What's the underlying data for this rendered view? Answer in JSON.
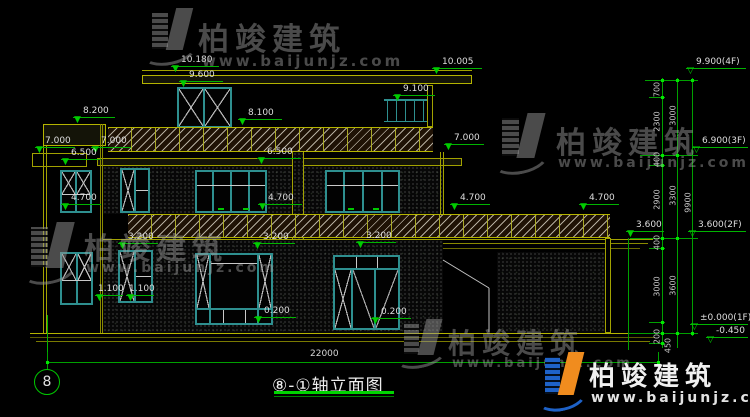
{
  "drawing": {
    "title": {
      "text": "⑧-①轴立面图"
    },
    "axis_bubble": "8",
    "total_dim": "22000"
  },
  "levels": [
    "10.180",
    "9.600",
    "10.005",
    "9.100",
    "8.200",
    "8.100",
    "7.000",
    "7.000",
    "6.500",
    "6.500",
    "7.000",
    "4.700",
    "4.700",
    "4.700",
    "4.700",
    "3.600",
    "3.200",
    "3.200",
    "3.200",
    "1.100",
    "1.100",
    "0.200",
    "0.200"
  ],
  "right_levels": [
    "9.900(4F)",
    "6.900(3F)",
    "3.600(2F)",
    "±0.000(1F)",
    "-0.450"
  ],
  "vdims": [
    "700",
    "2300",
    "400",
    "2900",
    "400",
    "3000",
    "200",
    "450",
    "3000",
    "3300",
    "3600",
    "9900"
  ],
  "glyphs": {
    "tri": "▼",
    "tri_open": "▽"
  },
  "watermark": {
    "brand": "柏竣建筑",
    "url": "www.baijunjz.com"
  },
  "colors": {
    "background": "#000000",
    "line_yellow": "#a2a200",
    "dim_green": "#00b400",
    "frame_teal": "#2e8f8f",
    "text_white": "#dedede",
    "logo_blue": "#1e62c8",
    "logo_orange": "#f08c1e"
  }
}
